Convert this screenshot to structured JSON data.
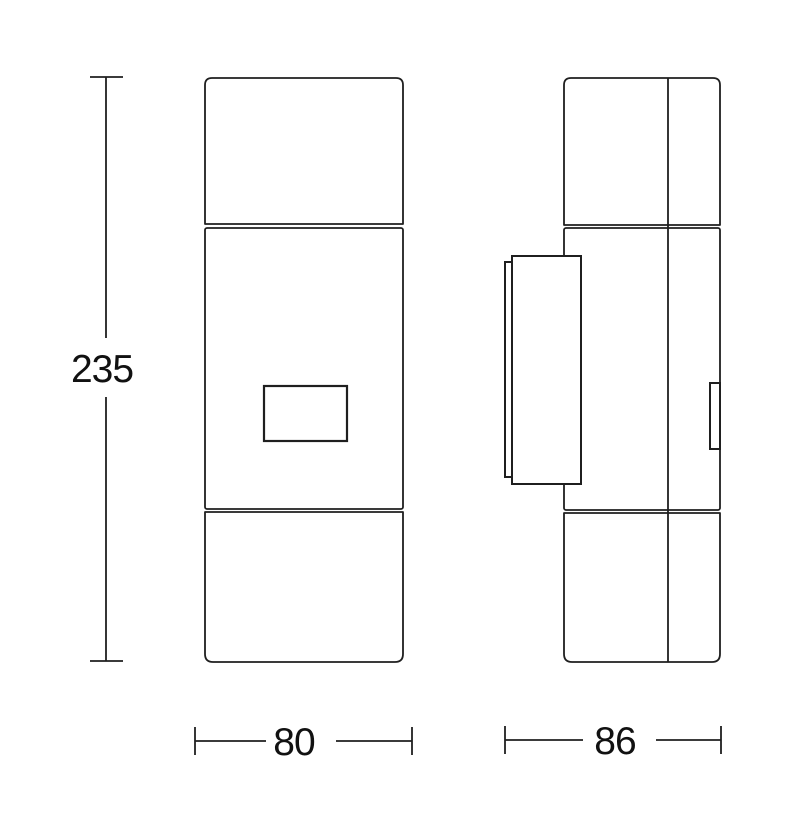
{
  "diagram": {
    "kind": "technical-drawing",
    "views": {
      "front": "front-view",
      "side": "side-view"
    },
    "dimensions": {
      "height": "235",
      "width": "80",
      "depth": "86"
    },
    "colors": {
      "background": "#ffffff",
      "line": "#1f1f1f",
      "text": "#111111"
    }
  }
}
